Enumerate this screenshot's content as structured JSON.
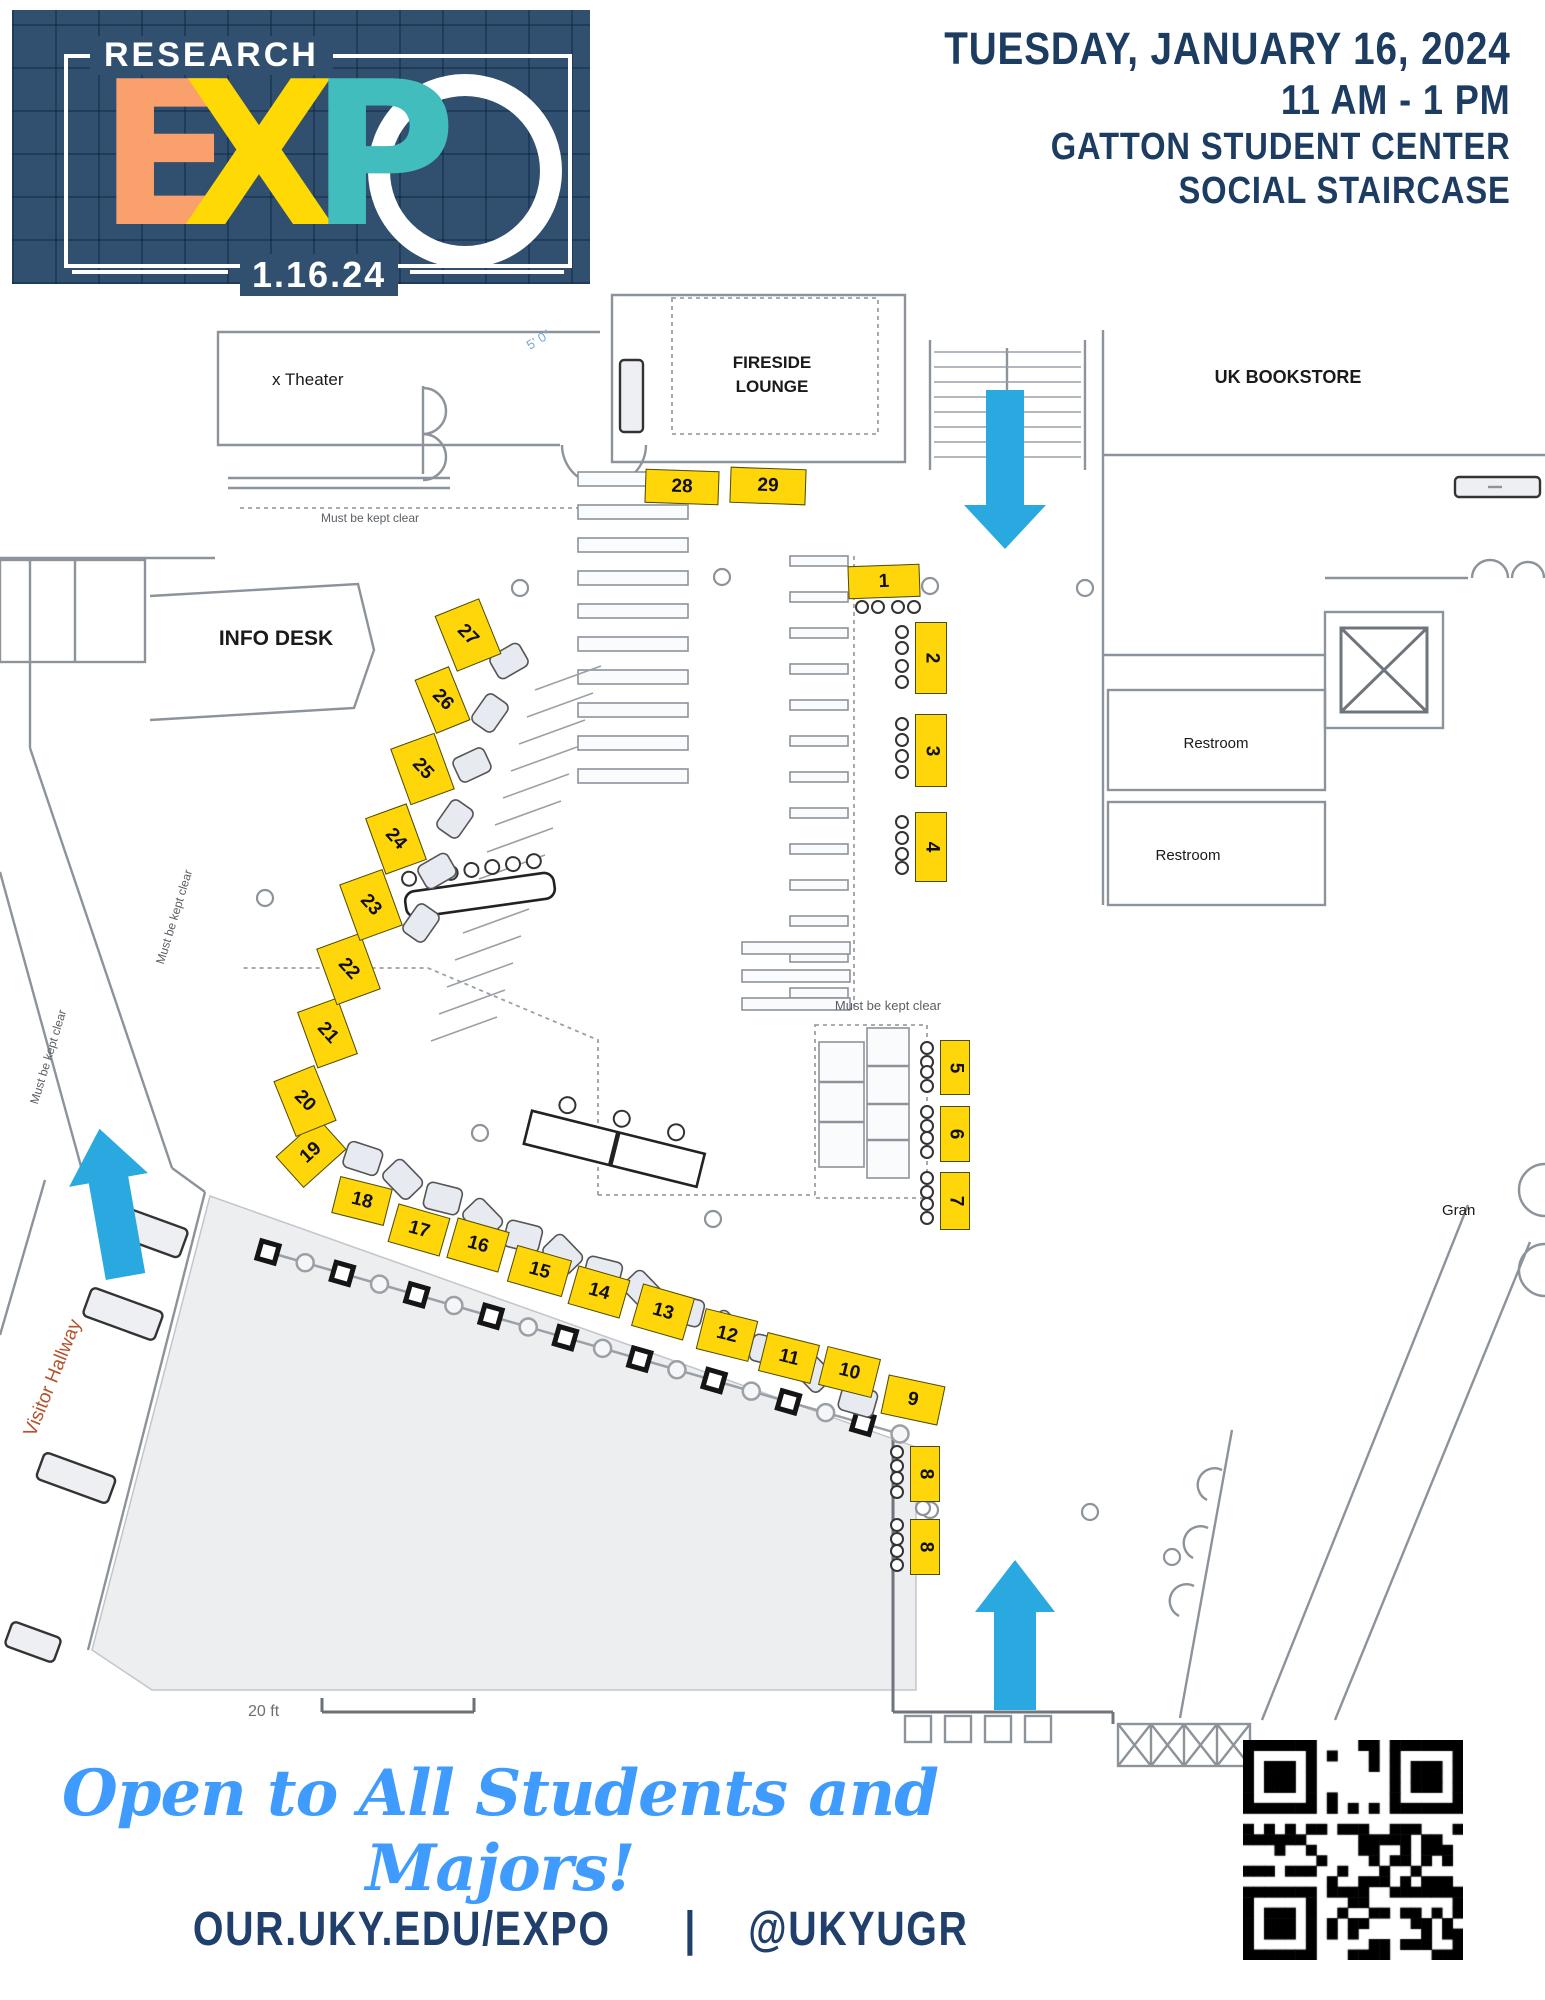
{
  "header": {
    "date_line": "TUESDAY, JANUARY 16, 2024",
    "time_line": "11 AM - 1 PM",
    "venue_line": "GATTON STUDENT CENTER",
    "room_line": "SOCIAL STAIRCASE"
  },
  "logo": {
    "top_label": "RESEARCH",
    "letter_e": "E",
    "letter_x": "X",
    "letter_p": "P",
    "date": "1.16.24"
  },
  "map": {
    "labels": {
      "theater": "x Theater",
      "fireside_line1": "FIRESIDE",
      "fireside_line2": "LOUNGE",
      "bookstore": "UK BOOKSTORE",
      "info_desk": "INFO DESK",
      "restroom_1": "Restroom",
      "restroom_2": "Restroom",
      "keep_clear_1": "Must be kept clear",
      "keep_clear_2": "Must be kept clear",
      "keep_clear_3": "Must be kept clear",
      "keep_clear_4": "Must be kept clear",
      "visitor_hallway": "Visitor Hallway",
      "grand": "Gran",
      "dimension": "5' 0\"",
      "scale": "20 ft"
    },
    "booths": {
      "n1": "1",
      "n2": "2",
      "n3": "3",
      "n4": "4",
      "n5": "5",
      "n6": "6",
      "n7": "7",
      "n8a": "8",
      "n8b": "8",
      "n9": "9",
      "n10": "10",
      "n11": "11",
      "n12": "12",
      "n13": "13",
      "n14": "14",
      "n15": "15",
      "n16": "16",
      "n17": "17",
      "n18": "18",
      "n19": "19",
      "n20": "20",
      "n21": "21",
      "n22": "22",
      "n23": "23",
      "n24": "24",
      "n25": "25",
      "n26": "26",
      "n27": "27",
      "n28": "28",
      "n29": "29"
    }
  },
  "footer": {
    "tagline": "Open to All Students and Majors!",
    "url": "OUR.UKY.EDU/EXPO",
    "separator": "|",
    "handle": "@UKYUGR"
  },
  "colors": {
    "booth_yellow": "#FFD60A",
    "arrow_blue": "#29A9E0",
    "navy": "#1D3C61",
    "logo_orange": "#F9A06C",
    "logo_yellow": "#FFD903",
    "logo_teal": "#41BDBD",
    "script_blue": "#3F9BFE",
    "hallway_orange": "#B5532C"
  }
}
